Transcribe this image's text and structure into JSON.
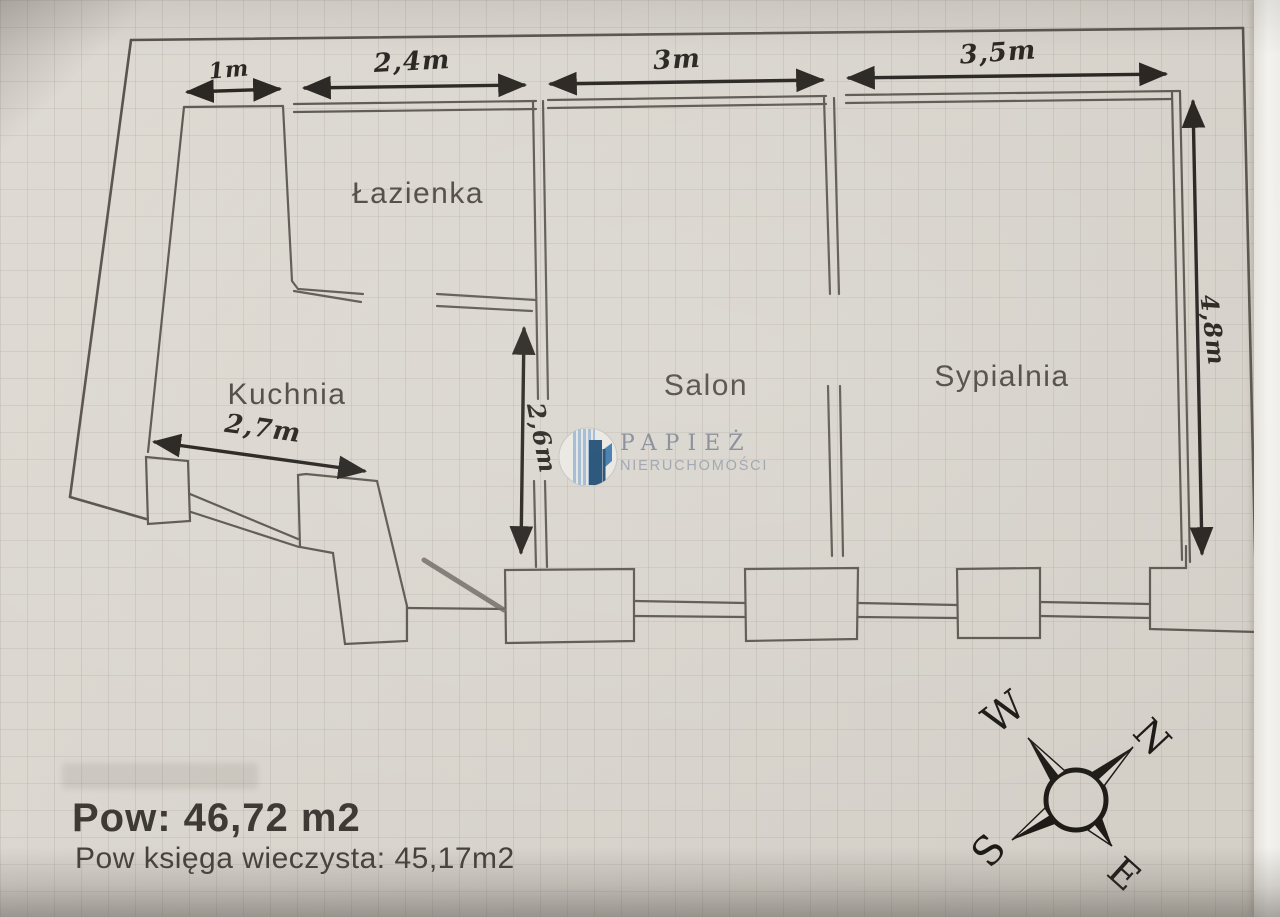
{
  "document": {
    "type": "apartment floor plan scan"
  },
  "rooms": [
    {
      "id": "lazienka",
      "name": "Łazienka"
    },
    {
      "id": "kuchnia",
      "name": "Kuchnia"
    },
    {
      "id": "salon",
      "name": "Salon"
    },
    {
      "id": "sypialnia",
      "name": "Sypialnia"
    }
  ],
  "dimensions": {
    "top": [
      {
        "label": "1m"
      },
      {
        "label": "2,4m"
      },
      {
        "label": "3m"
      },
      {
        "label": "3,5m"
      }
    ],
    "right": {
      "label": "4,8m"
    },
    "salon_west": {
      "label": "2,6m"
    },
    "kuchnia": {
      "label": "2,7m"
    }
  },
  "areas": {
    "total_label": "Pow: 46,72 m2",
    "registry_label": "Pow księga wieczysta: 45,17m2"
  },
  "compass": {
    "north": "N",
    "south": "S",
    "east": "E",
    "west": "W"
  },
  "logo": {
    "brand": "PAPIEŻ",
    "subtitle": "NIERUCHOMOŚCI"
  },
  "colors": {
    "paper": "#d9d5ce",
    "wall": "#5c5750",
    "ink": "#26231f",
    "logo_blue_dark": "#1d4a72",
    "logo_blue_light": "#9db9d2",
    "logo_text_gray": "#828895"
  }
}
